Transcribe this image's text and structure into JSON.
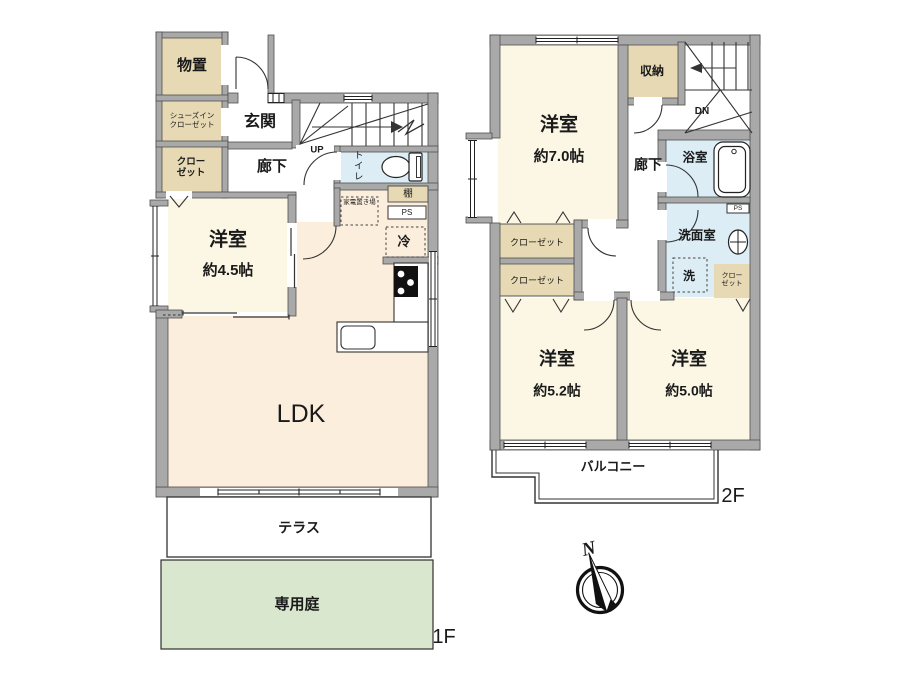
{
  "floor1": {
    "floor_label": "1F",
    "storage": "物置",
    "shoes_closet_line1": "シューズイン",
    "shoes_closet_line2": "クローゼット",
    "closet_line1": "クロー",
    "closet_line2": "ゼット",
    "entrance": "玄関",
    "hallway": "廊下",
    "stairs_up": "UP",
    "toilet": "トイレ",
    "shelf": "棚",
    "pipe_space": "PS",
    "appliance_space": "家電置き場",
    "fridge": "冷",
    "bedroom": "洋室",
    "bedroom_size": "約4.5帖",
    "ldk": "LDK",
    "terrace": "テラス",
    "private_garden": "専用庭"
  },
  "floor2": {
    "floor_label": "2F",
    "bedroom7": "洋室",
    "bedroom7_size": "約7.0帖",
    "storage": "収納",
    "stairs_down": "DN",
    "hallway": "廊下",
    "bathroom": "浴室",
    "pipe_space": "PS",
    "washroom": "洗面室",
    "laundry": "洗",
    "closet_upper": "クローゼット",
    "closet_lower": "クローゼット",
    "closet_small_line1": "クロー",
    "closet_small_line2": "ゼット",
    "bedroom52": "洋室",
    "bedroom52_size": "約5.2帖",
    "bedroom50": "洋室",
    "bedroom50_size": "約5.0帖",
    "balcony": "バルコニー"
  },
  "compass": {
    "north_label": "N"
  },
  "colors": {
    "wall": "#a9a9a9",
    "room_cream": "#fbf7e4",
    "room_peach": "#fceedd",
    "room_tan": "#e6d9b3",
    "room_blue": "#dcedf5",
    "garden_green": "#d8e7cd"
  }
}
